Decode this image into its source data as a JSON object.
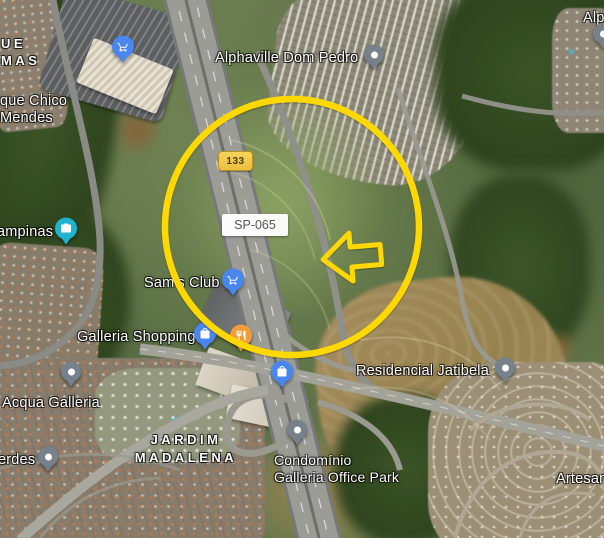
{
  "labels": {
    "alphaville": "Alphaville Dom Pedro",
    "alp_partial": "Alp",
    "chico_line1": "que Chico",
    "chico_line2": "Mendes",
    "campinas_partial": "ampinas",
    "sams_club": "Sam's Club",
    "galleria_shopping": "Galleria Shopping",
    "acqua_galleria": "Acqua Galleria",
    "verdes_partial": "erdes",
    "jatibela": "Residencial Jatibela",
    "condominio_line1": "Condomínio",
    "condominio_line2": "Galleria Office Park",
    "artesan_partial": "Artesan"
  },
  "districts": {
    "parque_line1": "UE",
    "parque_line2": "MAS",
    "jardim_line1": "JARDIM",
    "jardim_line2": "MADALENA"
  },
  "roads": {
    "shield_133": "133",
    "route_sp065": "SP-065"
  },
  "pins": {
    "mall_cart": "shopping-cart-pin",
    "alphaville": "generic-place-pin",
    "alp_edge": "generic-place-pin",
    "campinas_photo": "photo-camera-pin",
    "sams_cart": "shopping-cart-pin",
    "galleria_bag": "shopping-bag-pin",
    "restaurant": "restaurant-pin",
    "office_bag": "shopping-bag-pin",
    "acqua": "generic-place-pin",
    "verdes": "generic-place-pin",
    "condominio": "generic-place-pin",
    "jatibela": "generic-place-pin"
  },
  "annotations": {
    "highlight_color": "#FFD800",
    "circle": "highlight-circle-outline",
    "arrow": "left-arrow-outline"
  },
  "colors": {
    "pin_blue": "#4A86F0",
    "pin_teal": "#1FB4CC",
    "pin_orange": "#F09C3A",
    "pin_gray": "#76818C",
    "shield_bg": "#F2CC4F",
    "shield_text": "#4F3E00",
    "route_text": "#575757"
  }
}
